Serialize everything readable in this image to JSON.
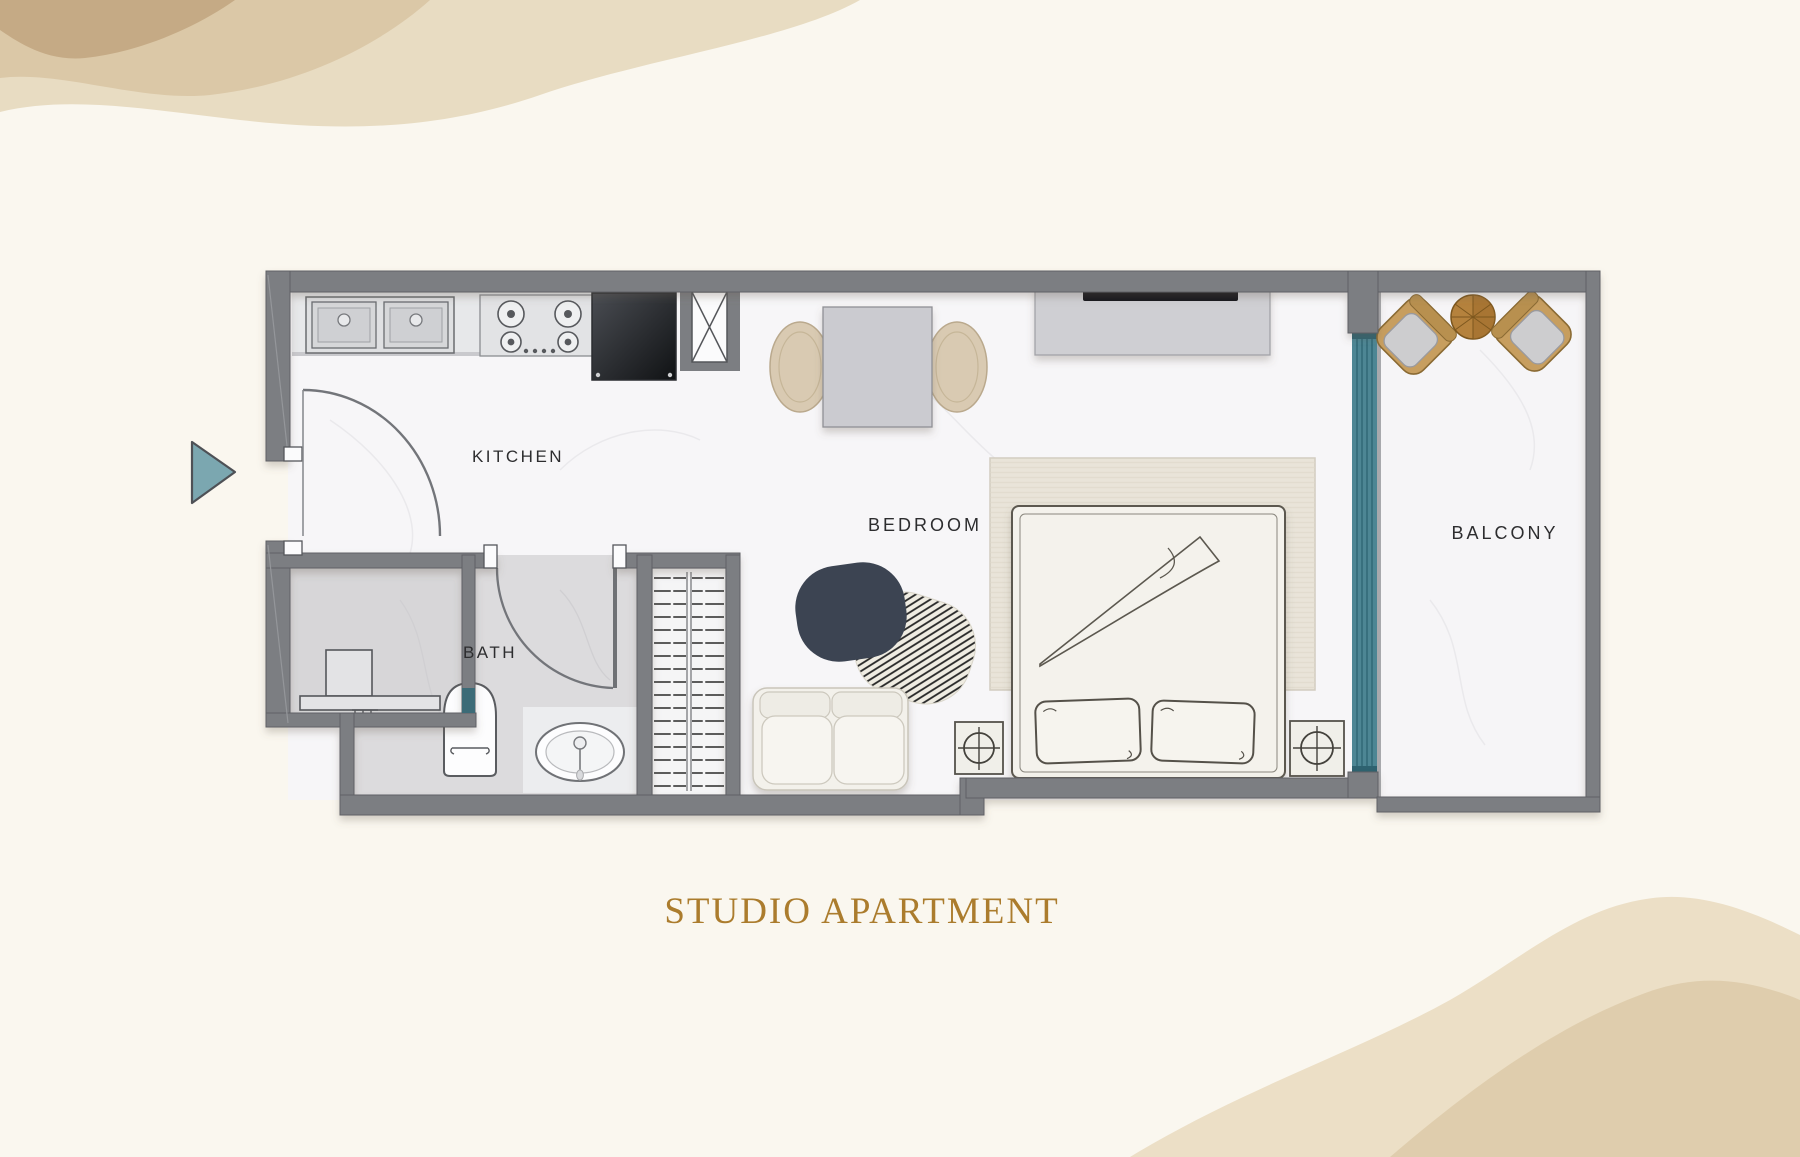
{
  "title": "STUDIO APARTMENT",
  "labels": {
    "kitchen": "KITCHEN",
    "bath": "BATH",
    "bedroom": "BEDROOM",
    "balcony": "BALCONY"
  },
  "colors": {
    "background": "#FAF7EF",
    "wall_gray": "#7C7E82",
    "window_teal": "#4D8694",
    "title_gold": "#AB7C2D",
    "entry_arrow_teal": "#7BA7B0",
    "floor_white": "#F7F6F8",
    "bath_floor_gray": "#DCDBDD",
    "rug_beige": "#E9E4D9",
    "wood_brown": "#B5823D",
    "watercolor_tan": "#E8DCC2"
  },
  "furniture": [
    "double-sink",
    "gas-hob",
    "refrigerator",
    "shaft-column",
    "dining-table",
    "dining-chairs",
    "tv-unit",
    "sofa",
    "accent-rugs",
    "wardrobe",
    "double-bed",
    "pillows",
    "nightstand-left",
    "nightstand-right",
    "toilet",
    "washbasin",
    "washing-machine",
    "bath-door",
    "entry-door",
    "window-strip",
    "balcony-armchairs",
    "balcony-round-table",
    "entry-arrow"
  ]
}
